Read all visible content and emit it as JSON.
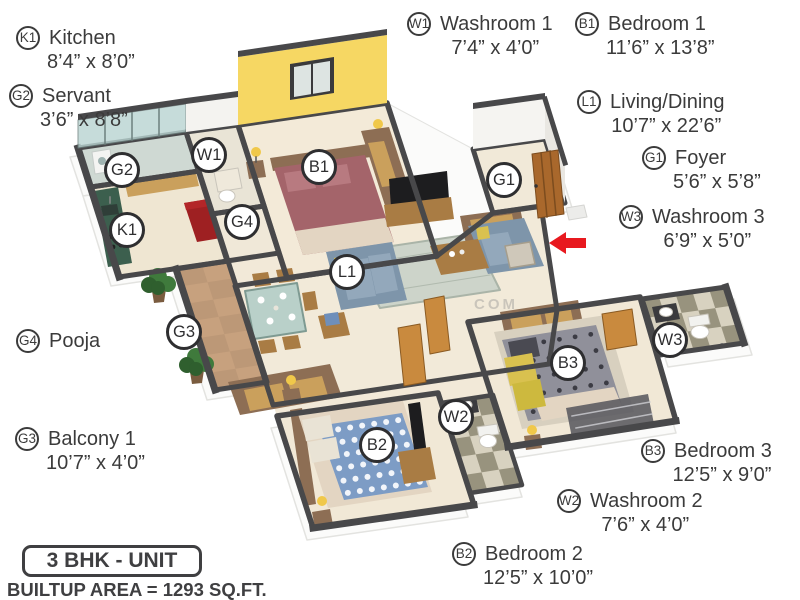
{
  "watermark": "COM",
  "footer": {
    "unit": "3 BHK - UNIT",
    "area": "BUILTUP AREA = 1293 SQ.FT."
  },
  "callouts": [
    {
      "id": "k1",
      "code": "K1",
      "name": "Kitchen",
      "dims": "8’4” x 8’0”"
    },
    {
      "id": "g2",
      "code": "G2",
      "name": "Servant",
      "dims": "3’6” x 8’8”"
    },
    {
      "id": "w1",
      "code": "W1",
      "name": "Washroom 1",
      "dims": "7’4” x 4’0”"
    },
    {
      "id": "b1",
      "code": "B1",
      "name": "Bedroom 1",
      "dims": "11’6” x 13’8”"
    },
    {
      "id": "l1",
      "code": "L1",
      "name": "Living/Dining",
      "dims": "10’7” x 22’6”"
    },
    {
      "id": "g1",
      "code": "G1",
      "name": "Foyer",
      "dims": "5’6” x 5’8”"
    },
    {
      "id": "w3",
      "code": "W3",
      "name": "Washroom 3",
      "dims": "6’9” x 5’0”"
    },
    {
      "id": "g4",
      "code": "G4",
      "name": "Pooja",
      "dims": ""
    },
    {
      "id": "g3",
      "code": "G3",
      "name": "Balcony 1",
      "dims": "10’7” x 4’0”"
    },
    {
      "id": "b3",
      "code": "B3",
      "name": "Bedroom 3",
      "dims": "12’5” x 9’0”"
    },
    {
      "id": "w2",
      "code": "W2",
      "name": "Washroom 2",
      "dims": "7’6” x 4’0”"
    },
    {
      "id": "b2",
      "code": "B2",
      "name": "Bedroom 2",
      "dims": "12’5” x 10’0”"
    }
  ],
  "colors": {
    "wall": "#48484a",
    "slab": "#fbfbfa",
    "slab_edge": "#e3e3e0",
    "floor": "#f2e9d8",
    "yellow_wall": "#f6d763",
    "window_pane": "#dde4e2",
    "glass": "#b9d4d2",
    "tile_light": "#d8d2c0",
    "tile_dark": "#918c77",
    "balcony_floor": "#c7a17e",
    "balcony_line": "#a9886a",
    "wood_dark": "#8d6e54",
    "wood_mid": "#a97c44",
    "wood_light": "#caa05c",
    "door_wood": "#c98a3e",
    "entry_door": "#a9682c",
    "counter_green": "#3c5f4e",
    "cabinet_red": "#9e2022",
    "bed1": "#a4646a",
    "bed1_pillow": "#b87a80",
    "bed2": "#7d9cc5",
    "bed3": "#90909a",
    "bed_sheet": "#e3d5c2",
    "sofa": "#7e95aa",
    "sofa_light": "#93a8bb",
    "pillow_yellow": "#d9c14f",
    "rug": "#cdd4ca",
    "rug_line": "#aab4a8",
    "rug_dark": "#55555c",
    "dining_glass": "#b9d0c9",
    "plant": "#3f7a3c",
    "plant_dark": "#2f5f2e",
    "pot": "#7a5c3f",
    "lamp": "#f0c84a",
    "tv": "#1d1d1f",
    "fixture_stroke": "#c9c5bb",
    "arrow": "#e8191f",
    "text": "#3b3b3b"
  }
}
